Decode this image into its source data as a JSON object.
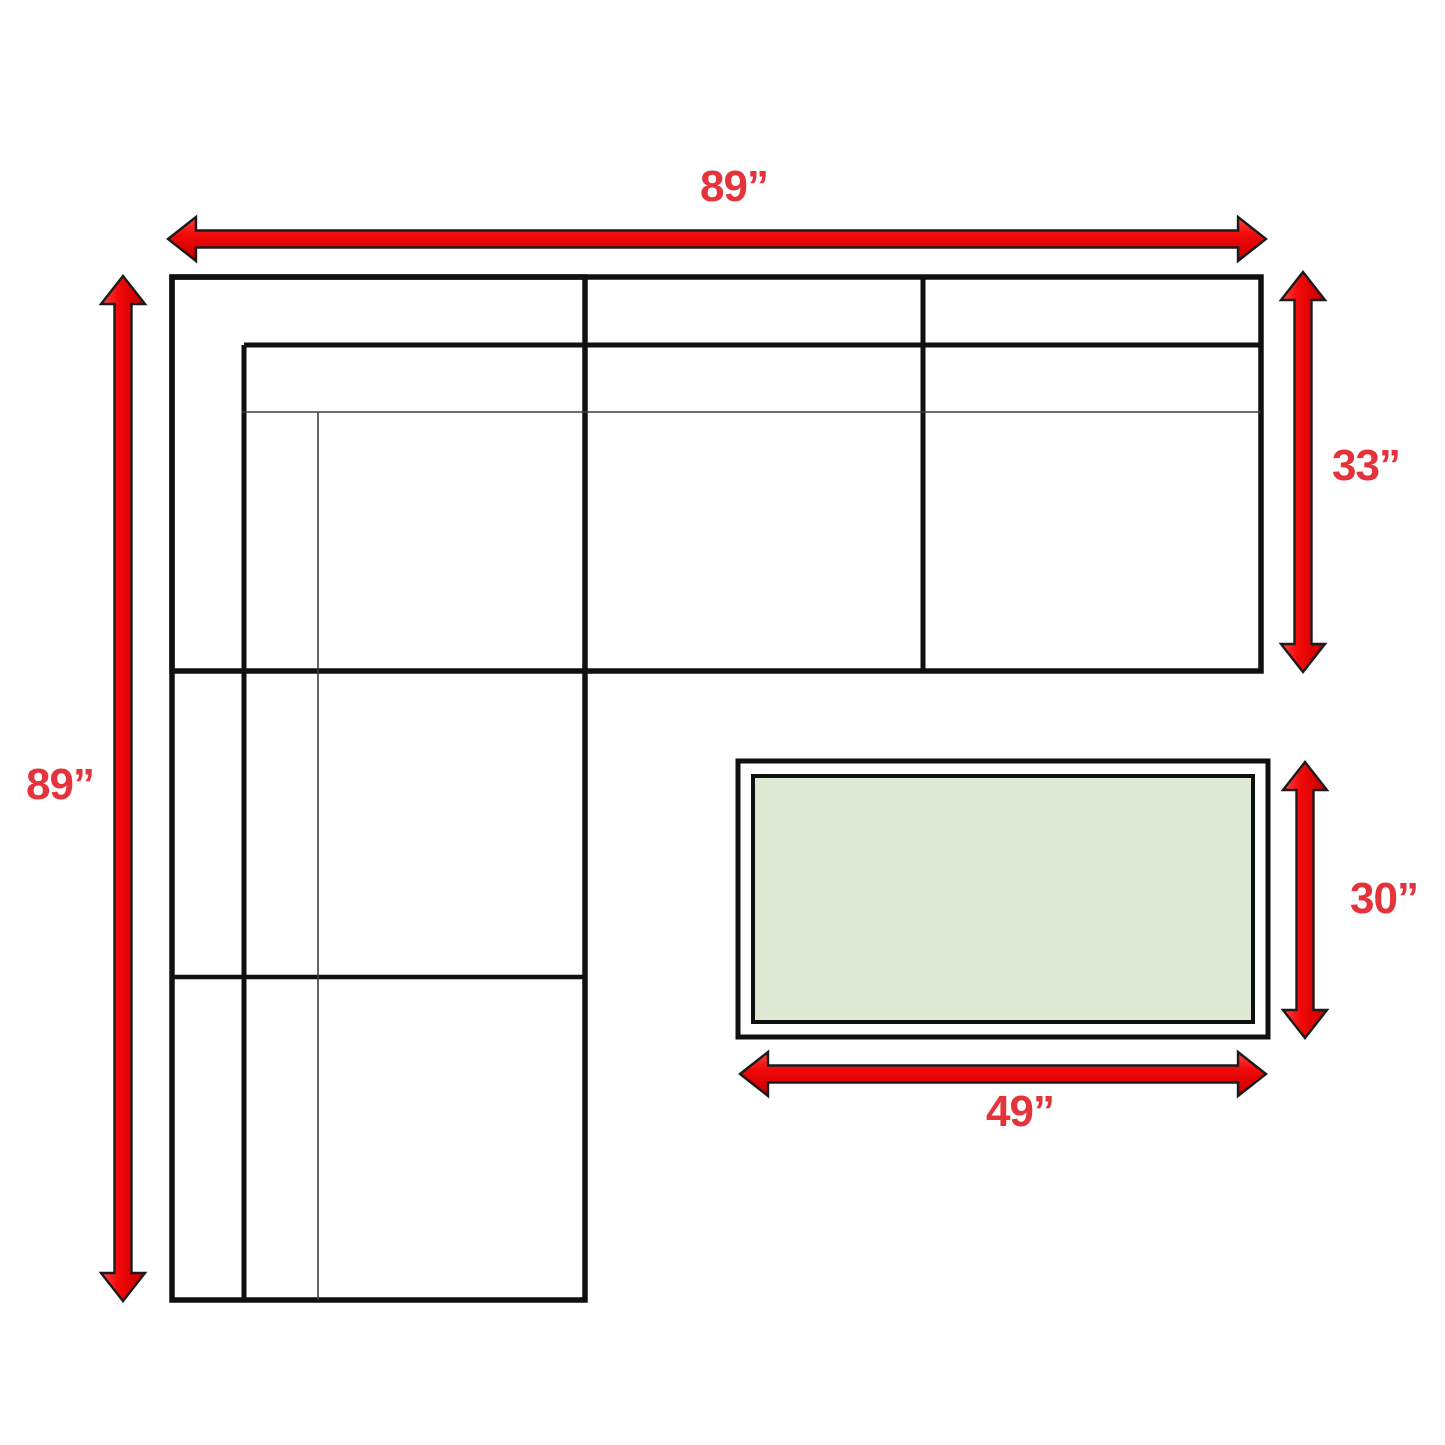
{
  "page": {
    "background": "#ffffff"
  },
  "diagram": {
    "kind": "sectional-sofa-with-ottoman-dimension-floorplan",
    "colors": {
      "sofa_outline": "#101010",
      "cushion_line": "#3d3d3d",
      "arrow_fill": "#ee0808",
      "arrow_outline": "#1b1b1b",
      "label_text": "#e5333b",
      "ottoman_fill": "#dee8d4",
      "ottoman_border": "#101010"
    },
    "dimensions": {
      "sofa_width_label": "89”",
      "sofa_left_depth_label": "89”",
      "sofa_right_depth_label": "33”",
      "ottoman_width_label": "49”",
      "ottoman_depth_label": "30”"
    }
  }
}
